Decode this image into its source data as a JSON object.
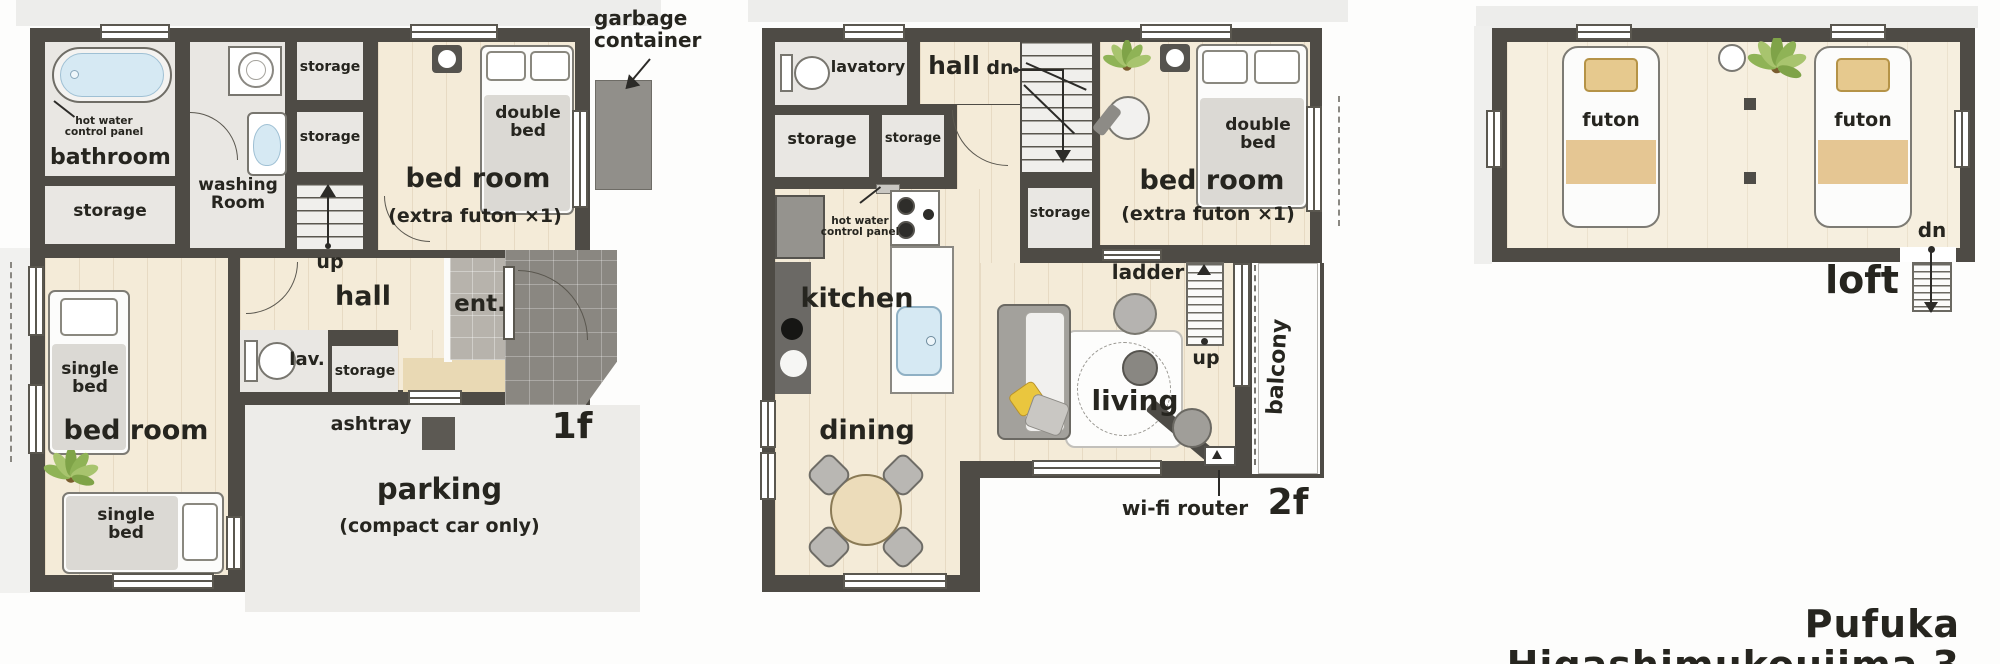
{
  "title": "Pufuka Higashimukoujima 3",
  "colors": {
    "wall": "#4e4b45",
    "wood_floor": "#f4ebd8",
    "gray_room": "#e9e7e3",
    "entrance_tile": "#8a8781",
    "genkan_tile": "#b7b3ac",
    "water_blue": "#d6e9f3",
    "plant_green": "#8fb356",
    "pillow_yellow": "#eac63e",
    "futon_tan": "#e6c98e",
    "parking_gray": "#edece9"
  },
  "labels": {
    "bathroom": "bathroom",
    "hot_water_panel": "hot water\ncontrol panel",
    "washing_room": "washing\nRoom",
    "storage": "storage",
    "up": "up",
    "dn": "dn",
    "hall": "hall",
    "ent": "ent.",
    "lav": "lav.",
    "lavatory": "lavatory",
    "bed_room": "bed room",
    "double_bed": "double\nbed",
    "single_bed": "single\nbed",
    "extra_futon": "(extra futon ×1)",
    "futon": "futon",
    "ladder": "ladder",
    "balcony": "balcony",
    "kitchen": "kitchen",
    "dining": "dining",
    "living": "living",
    "parking": "parking",
    "parking_note": "(compact car only)",
    "ashtray": "ashtray",
    "garbage_container": "garbage\ncontainer",
    "wifi_router": "wi-fi router",
    "floor_1": "1f",
    "floor_2": "2f",
    "floor_loft": "loft"
  }
}
